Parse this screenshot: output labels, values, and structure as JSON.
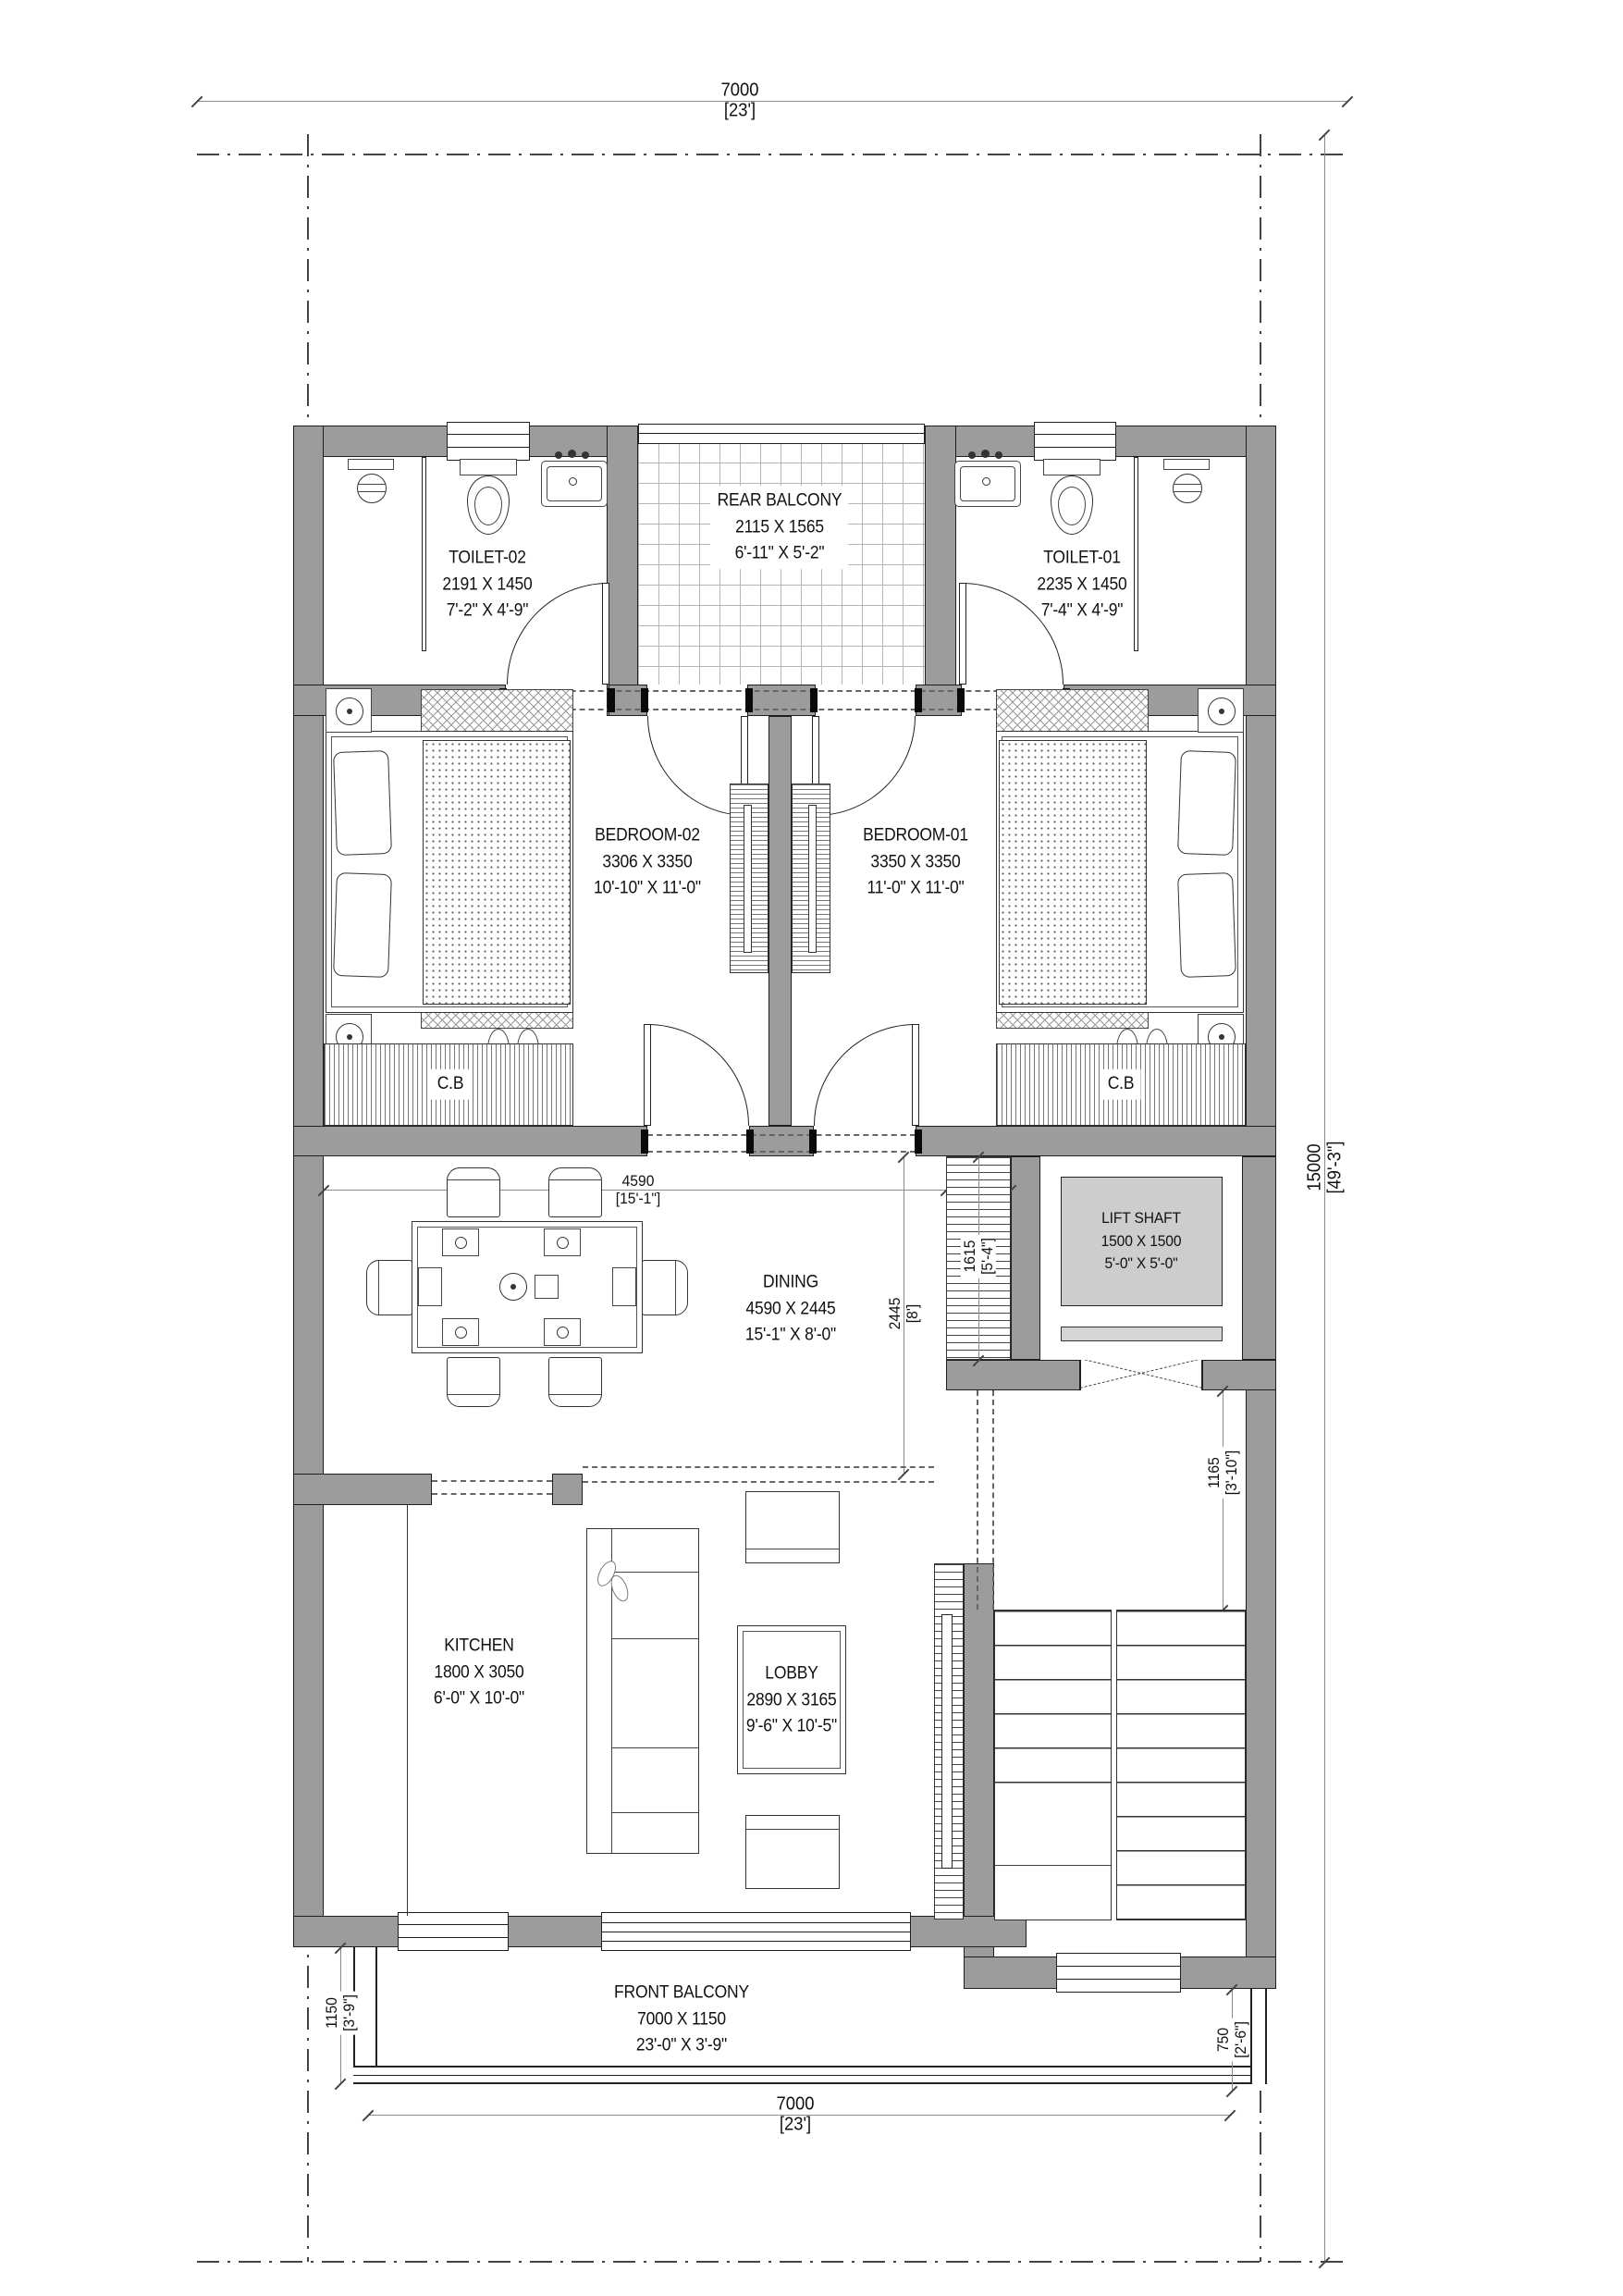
{
  "colors": {
    "wall": "#9c9c9c",
    "lift_car": "#cdcdcd",
    "outline": "#1f1f1f",
    "dim_line": "#8a8a8a"
  },
  "dims": {
    "top": {
      "v": "7000",
      "u": "[23']"
    },
    "bottom": {
      "v": "7000",
      "u": "[23']"
    },
    "right": {
      "v": "15000",
      "u": "[49'-3\"]"
    },
    "dining_w": {
      "v": "4590",
      "u": "[15'-1\"]"
    },
    "stair_w": {
      "v": "450",
      "u": "[1'-6\"]"
    },
    "stair_l": {
      "v": "1615",
      "u": "[5'-4\"]"
    },
    "dining_d": {
      "v": "2445",
      "u": "[8']"
    },
    "lift_lobby": {
      "v": "1165",
      "u": "[3'-10\"]"
    },
    "front_balcony_d": {
      "v": "1150",
      "u": "[3'-9\"]"
    },
    "stair_landing": {
      "v": "750",
      "u": "[2'-6\"]"
    }
  },
  "rooms": {
    "rear_balcony": {
      "name": "REAR BALCONY",
      "mm": "2115 X 1565",
      "ft": "6'-11\" X 5'-2\""
    },
    "toilet02": {
      "name": "TOILET-02",
      "mm": "2191 X 1450",
      "ft": "7'-2\" X 4'-9\""
    },
    "toilet01": {
      "name": "TOILET-01",
      "mm": "2235 X 1450",
      "ft": "7'-4\" X 4'-9\""
    },
    "bedroom02": {
      "name": "BEDROOM-02",
      "mm": "3306 X 3350",
      "ft": "10'-10\" X 11'-0\""
    },
    "bedroom01": {
      "name": "BEDROOM-01",
      "mm": "3350 X 3350",
      "ft": "11'-0\" X 11'-0\""
    },
    "dining": {
      "name": "DINING",
      "mm": "4590 X 2445",
      "ft": "15'-1\" X 8'-0\""
    },
    "lift": {
      "name": "LIFT SHAFT",
      "mm": "1500 X 1500",
      "ft": "5'-0\" X 5'-0\""
    },
    "kitchen": {
      "name": "KITCHEN",
      "mm": "1800 X 3050",
      "ft": "6'-0\" X 10'-0\""
    },
    "lobby": {
      "name": "LOBBY",
      "mm": "2890 X 3165",
      "ft": "9'-6\" X 10'-5\""
    },
    "front_balcony": {
      "name": "FRONT BALCONY",
      "mm": "7000 X 1150",
      "ft": "23'-0\" X 3'-9\""
    },
    "cb": {
      "name": "C.B"
    }
  }
}
